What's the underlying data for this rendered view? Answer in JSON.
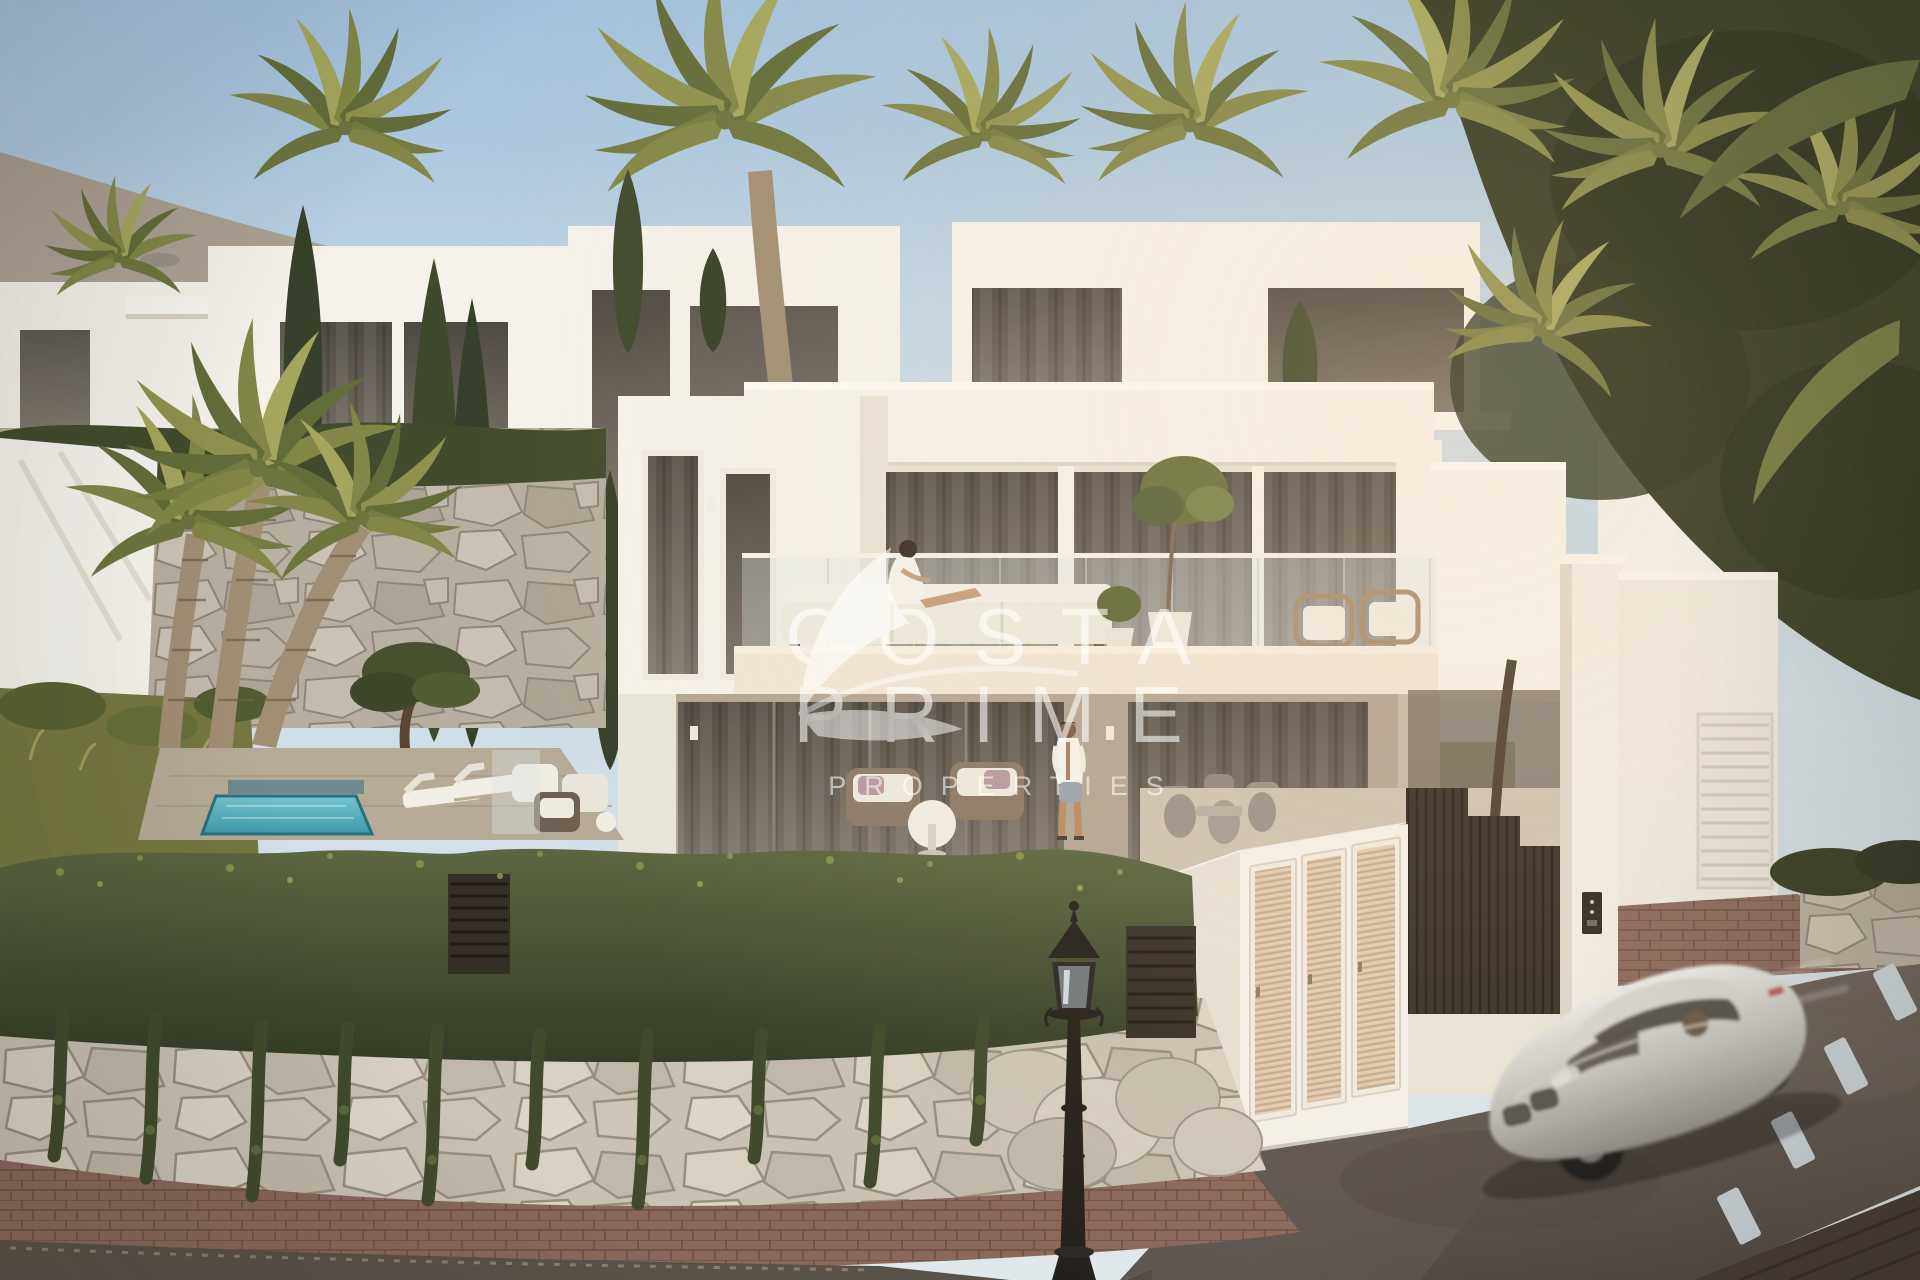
{
  "watermark": {
    "line1": "COSTA",
    "line2": "PRIME",
    "line3": "PROPERTIES",
    "icon": "leaf-swoosh-icon",
    "color": "#ffffff",
    "opacity": "0.58"
  },
  "palette": {
    "sky_top": "#a3c2dd",
    "sky_horizon": "#e1e8ec",
    "mountain": "#9c8f7e",
    "villa_white": "#f5f2eb",
    "terrace_cream": "#efe7d7",
    "lower_wall": "#b2a695",
    "glass_dark": "#55504a",
    "hedge_green": "#4d5733",
    "ivy_dark": "#414b2c",
    "palm": "#828748",
    "palm_dark": "#636d3a",
    "cypress": "#3f4a2c",
    "stone_wall": "#b8b1a2",
    "stone_light": "#cfc8b9",
    "pool": "#55aec0",
    "road": "#5f5751",
    "road_mark": "#ccd6dc",
    "brick": "#8a685b",
    "fence": "#362f27",
    "louver_door": "#e3cdb3",
    "car_silver": "#c9c8c4",
    "lamp_black": "#24201c",
    "watermark": "#ffffff"
  }
}
